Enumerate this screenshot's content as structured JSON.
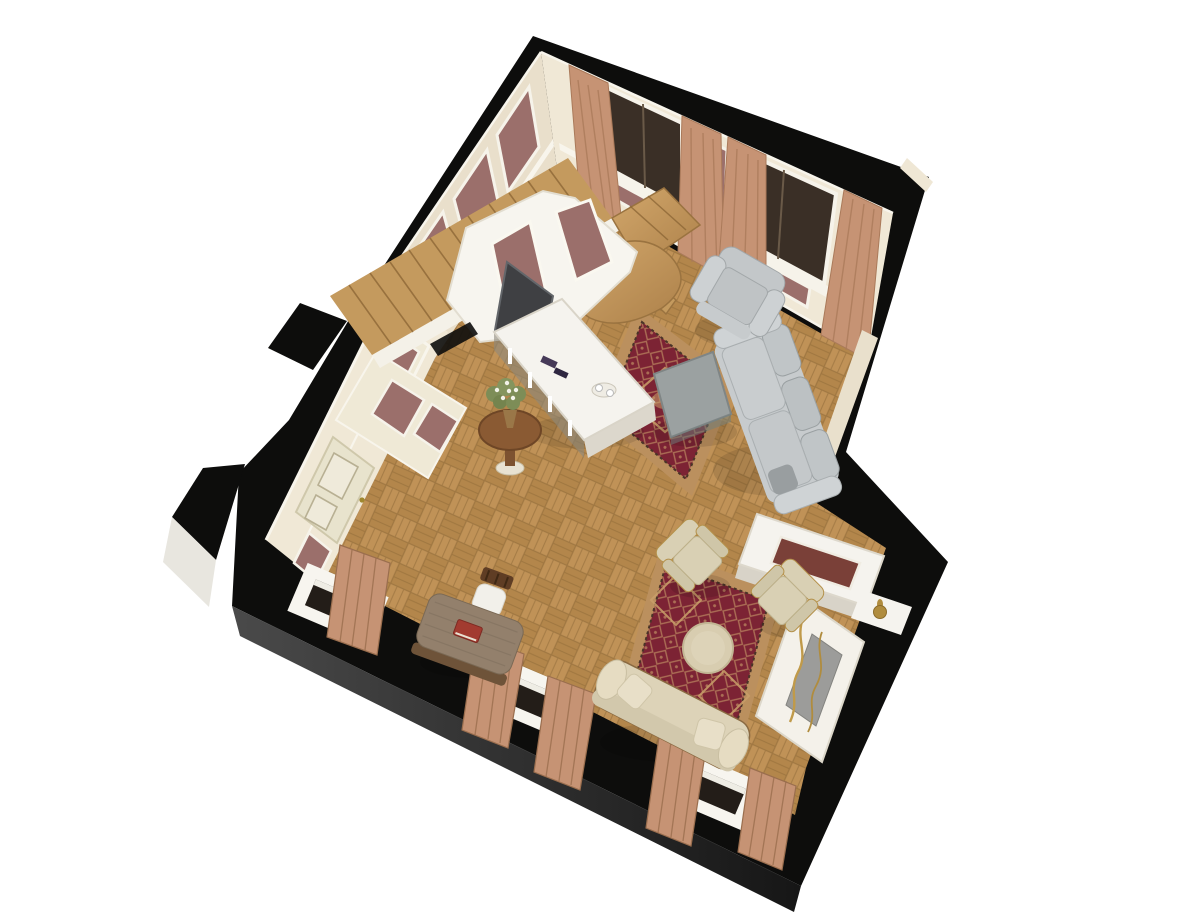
{
  "scene": {
    "kind": "3d-floorplan-cutaway-render",
    "room": "classic living room with staircase, two seating areas and fireplace nook",
    "view": "aerial isometric dollhouse view, room rotated diagonally on white background"
  },
  "colors": {
    "background": "#ffffff",
    "wallTop": "#0d0d0c",
    "outerFaceDark": "#2e2e2e",
    "outerFaceLight": "#e8e6df",
    "wallCream": "#f0e8d6",
    "wallCreamShade": "#e9dfcb",
    "trimWhite": "#f8f5ec",
    "wallpaper": "#9b6f6b",
    "door": "#e8e3cd",
    "glass": "#3a2f26",
    "curtain": "#c69374",
    "floorA": "#c09257",
    "floorB": "#b3864b",
    "floorSeam": "#8f6a38",
    "stairWood": "#c49a5e",
    "rugField": "#7c2334",
    "rugBorder": "#bb905e",
    "rugMotif": "#c9a06a",
    "sofaGray": "#c7cbcd",
    "coffeeTableGray": "#9ba1a1",
    "beige": "#d9d0b4",
    "settee": "#ddd3b8",
    "deskWood": "#93806c",
    "chairWood": "#5f3d24",
    "tvDark": "#3f4043",
    "consoleWhite": "#f5f3ee",
    "gold": "#b08c3e"
  },
  "objects": {
    "exterior_walls": "thick walls shown in black from above, with two piers on the west side",
    "staircase": "wooden stair flight along north-west wall with curved lower landing and winders",
    "stair_half_wall": "peaked white screen wall with wallpaper panels beside the stairs",
    "tv": "flat screen leaning on the stair screen wall",
    "tv_console": "long white console table with remotes and a tray",
    "flower_stand": "round wooden pedestal table with white bouquet",
    "entry_door": "ivory panelled door in the west wall",
    "north_windows": "two tall dark windows with tan curtains in the north-east wall",
    "wallpaper_panels": "framed mauve damask panels on cream walls",
    "living_rug": "red oriental rug under coffee table",
    "coffee_table": "gray stone-top rectangular coffee table",
    "sofa": "light gray three-seat sofa with back against the east wall",
    "gray_armchair": "light gray armchair in the north corner",
    "salon_rug": "red oriental rug in the south seating area",
    "round_ottoman": "round cream ottoman table on the salon rug",
    "beige_armchairs": "two beige fauteuils with gilt frames",
    "settee": "cream upholstered settee along the south wall",
    "writing_desk": "small taupe writing desk with red book and wooden chair",
    "south_windows": "three white window boxes piercing the south wall, with curtains",
    "console_cabinet": "low white cabinet with inlaid top in the east nook",
    "fireplace": "white mantel fireplace with gray insert and gilt garland",
    "decor_vase": "small gold vase on a white ledge"
  }
}
